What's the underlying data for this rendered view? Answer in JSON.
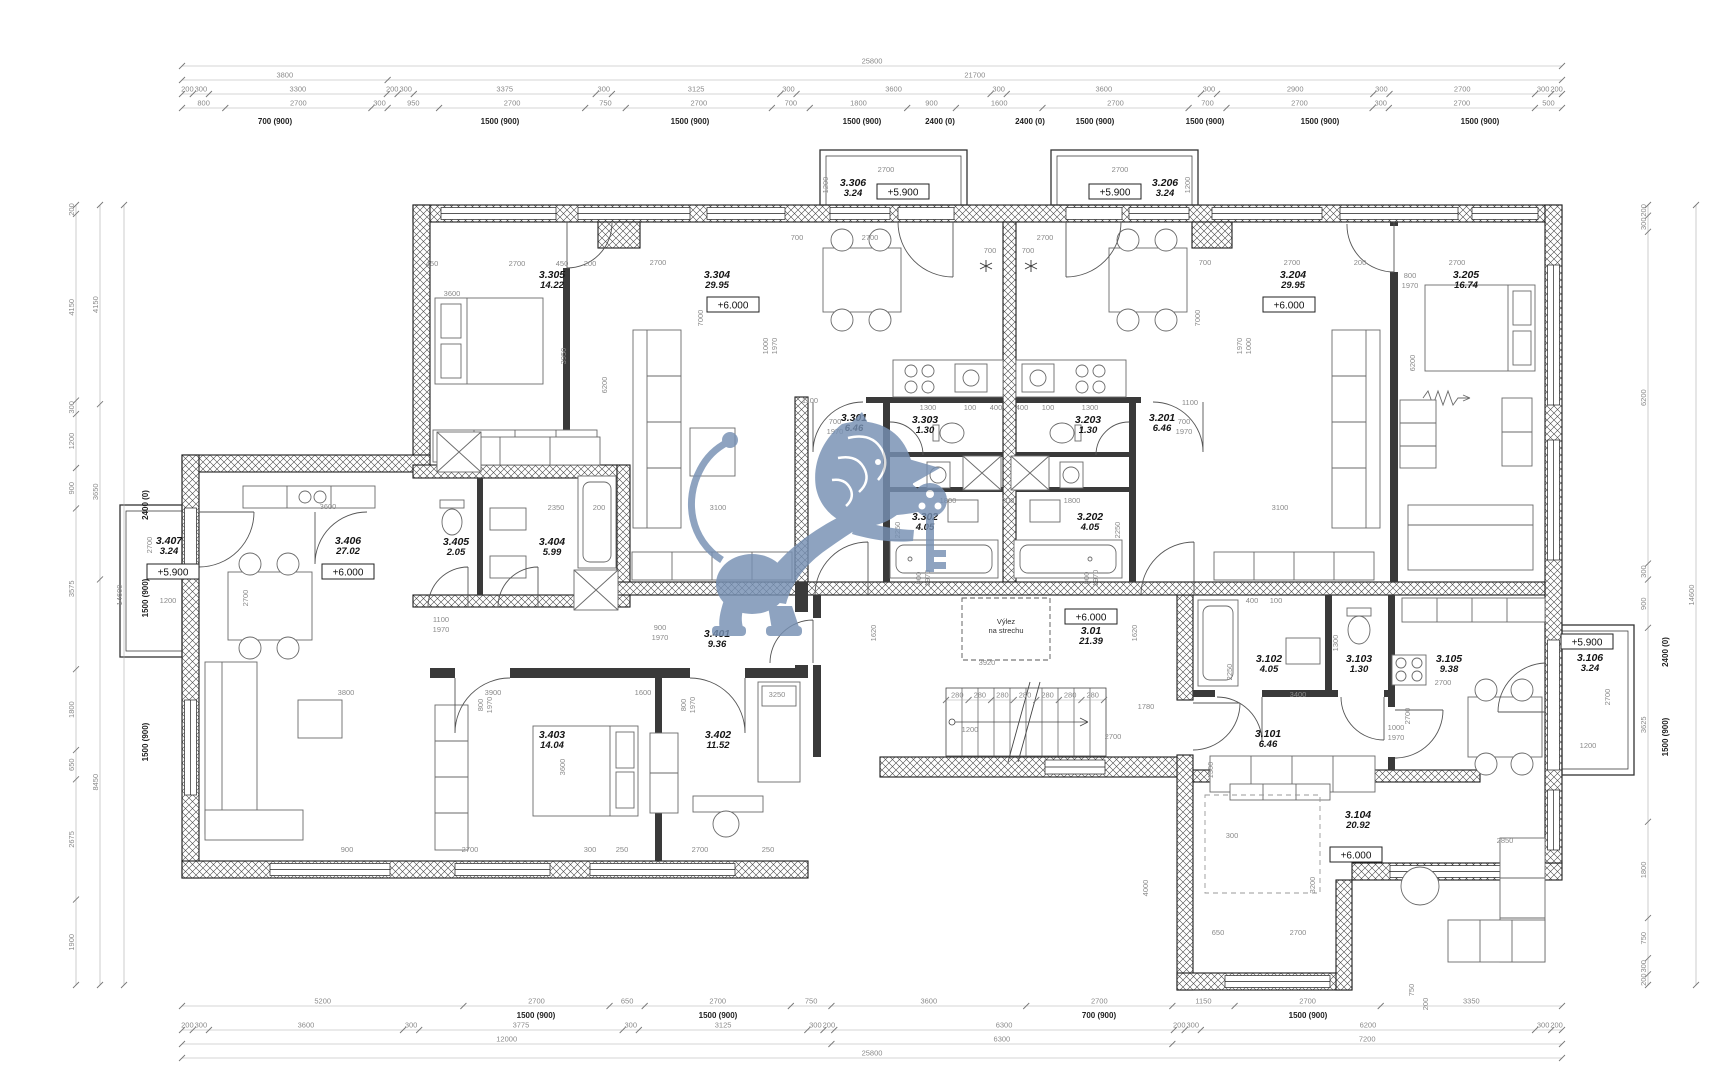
{
  "title": "Floor plan drawing — level +6.000, apartments 3.101–3.407 with common staircase 3.01",
  "watermark": {
    "icon": "lion-with-key-watermark",
    "color": "#7690b3"
  },
  "annotations": [
    {
      "x": 1006,
      "y": 624,
      "t": "Výlez"
    },
    {
      "x": 1006,
      "y": 633,
      "t": "na strechu"
    }
  ],
  "rooms": [
    {
      "id": "3.305",
      "area": "14.22",
      "x": 552,
      "y": 278
    },
    {
      "id": "3.304",
      "area": "29.95",
      "x": 717,
      "y": 278,
      "elev": "+6.000",
      "ex": 733,
      "ey": 305
    },
    {
      "id": "3.306",
      "area": "3.24",
      "x": 853,
      "y": 186,
      "elev": "+5.900",
      "ex": 903,
      "ey": 192
    },
    {
      "id": "3.301",
      "area": "6.46",
      "x": 854,
      "y": 421
    },
    {
      "id": "3.303",
      "area": "1.30",
      "x": 925,
      "y": 423
    },
    {
      "id": "3.302",
      "area": "4.05",
      "x": 925,
      "y": 520
    },
    {
      "id": "3.203",
      "area": "1.30",
      "x": 1088,
      "y": 423
    },
    {
      "id": "3.202",
      "area": "4.05",
      "x": 1090,
      "y": 520
    },
    {
      "id": "3.201",
      "area": "6.46",
      "x": 1162,
      "y": 421
    },
    {
      "id": "3.204",
      "area": "29.95",
      "x": 1293,
      "y": 278,
      "elev": "+6.000",
      "ex": 1289,
      "ey": 305
    },
    {
      "id": "3.206",
      "area": "3.24",
      "x": 1165,
      "y": 186,
      "elev": "+5.900",
      "ex": 1115,
      "ey": 192
    },
    {
      "id": "3.205",
      "area": "16.74",
      "x": 1466,
      "y": 278
    },
    {
      "id": "3.407",
      "area": "3.24",
      "x": 169,
      "y": 544,
      "elev": "+5.900",
      "ex": 173,
      "ey": 572
    },
    {
      "id": "3.406",
      "area": "27.02",
      "x": 348,
      "y": 544,
      "elev": "+6.000",
      "ex": 348,
      "ey": 572
    },
    {
      "id": "3.405",
      "area": "2.05",
      "x": 456,
      "y": 545
    },
    {
      "id": "3.404",
      "area": "5.99",
      "x": 552,
      "y": 545
    },
    {
      "id": "3.401",
      "area": "9.36",
      "x": 717,
      "y": 637
    },
    {
      "id": "3.403",
      "area": "14.04",
      "x": 552,
      "y": 738
    },
    {
      "id": "3.402",
      "area": "11.52",
      "x": 718,
      "y": 738
    },
    {
      "id": "3.01",
      "area": "21.39",
      "x": 1091,
      "y": 634,
      "elev": "+6.000",
      "ex": 1091,
      "ey": 617
    },
    {
      "id": "3.101",
      "area": "6.46",
      "x": 1268,
      "y": 737
    },
    {
      "id": "3.102",
      "area": "4.05",
      "x": 1269,
      "y": 662
    },
    {
      "id": "3.103",
      "area": "1.30",
      "x": 1359,
      "y": 662
    },
    {
      "id": "3.105",
      "area": "9.38",
      "x": 1449,
      "y": 662
    },
    {
      "id": "3.104",
      "area": "20.92",
      "x": 1358,
      "y": 818,
      "elev": "+6.000",
      "ex": 1356,
      "ey": 855
    },
    {
      "id": "3.106",
      "area": "3.24",
      "x": 1590,
      "y": 661,
      "elev": "+5.900",
      "ex": 1587,
      "ey": 642
    }
  ],
  "dims": {
    "h": [
      {
        "y": 66,
        "x0": 182,
        "x1": 1562,
        "items": [
          "25800"
        ]
      },
      {
        "y": 80,
        "x0": 182,
        "x1": 1562,
        "items": [
          "3800",
          "21700"
        ]
      },
      {
        "y": 94,
        "x0": 182,
        "x1": 1562,
        "items": [
          "200",
          "300",
          "3300",
          "200",
          "300",
          "3375",
          "300",
          "3125",
          "300",
          "3600",
          "300",
          "3600",
          "300",
          "2900",
          "300",
          "2700",
          "300",
          "200"
        ]
      },
      {
        "y": 108,
        "x0": 182,
        "x1": 1562,
        "items": [
          "800",
          "2700",
          "300",
          "950",
          "2700",
          "750",
          "2700",
          "700",
          "1800",
          "900",
          "1600",
          "2700",
          "700",
          "2700",
          "300",
          "2700",
          "500"
        ]
      },
      {
        "y": 1006,
        "x0": 182,
        "x1": 1562,
        "items": [
          "5200",
          "2700",
          "650",
          "2700",
          "750",
          "3600",
          "2700",
          "1150",
          "2700",
          "3350"
        ]
      },
      {
        "y": 1030,
        "x0": 182,
        "x1": 1562,
        "items": [
          "200",
          "300",
          "3600",
          "300",
          "3775",
          "300",
          "3125",
          "300",
          "200",
          "6300",
          "200",
          "300",
          "6200",
          "300",
          "200"
        ]
      },
      {
        "y": 1044,
        "x0": 182,
        "x1": 1562,
        "items": [
          "12000",
          "6300",
          "7200"
        ]
      },
      {
        "y": 1058,
        "x0": 182,
        "x1": 1562,
        "items": [
          "25800"
        ]
      },
      {
        "y": 700,
        "x0": 946,
        "x1": 1104,
        "items": [
          "280",
          "280",
          "280",
          "280",
          "280",
          "280",
          "280"
        ]
      }
    ],
    "v": [
      {
        "x": 76,
        "y0": 205,
        "y1": 985,
        "items": [
          "200",
          "4150",
          "300",
          "1200",
          "900",
          "3575",
          "1800",
          "650",
          "2675",
          "1900"
        ]
      },
      {
        "x": 100,
        "y0": 205,
        "y1": 985,
        "items": [
          "4150",
          "3650",
          "8450"
        ]
      },
      {
        "x": 124,
        "y0": 205,
        "y1": 985,
        "items": [
          "14600"
        ]
      },
      {
        "x": 1648,
        "y0": 205,
        "y1": 985,
        "items": [
          "200",
          "300",
          "6200",
          "300",
          "900",
          "3625",
          "1800",
          "750",
          "300",
          "200"
        ]
      },
      {
        "x": 1696,
        "y0": 205,
        "y1": 985,
        "items": [
          "14600"
        ]
      }
    ],
    "free": [
      {
        "x": 275,
        "y": 124,
        "t": "700 (900)",
        "b": 1
      },
      {
        "x": 500,
        "y": 124,
        "t": "1500 (900)",
        "b": 1
      },
      {
        "x": 690,
        "y": 124,
        "t": "1500 (900)",
        "b": 1
      },
      {
        "x": 862,
        "y": 124,
        "t": "1500 (900)",
        "b": 1
      },
      {
        "x": 940,
        "y": 124,
        "t": "2400 (0)",
        "b": 1
      },
      {
        "x": 1030,
        "y": 124,
        "t": "2400 (0)",
        "b": 1
      },
      {
        "x": 1095,
        "y": 124,
        "t": "1500 (900)",
        "b": 1
      },
      {
        "x": 1205,
        "y": 124,
        "t": "1500 (900)",
        "b": 1
      },
      {
        "x": 1320,
        "y": 124,
        "t": "1500 (900)",
        "b": 1
      },
      {
        "x": 1480,
        "y": 124,
        "t": "1500 (900)",
        "b": 1
      },
      {
        "x": 536,
        "y": 1018,
        "t": "1500 (900)",
        "b": 1
      },
      {
        "x": 718,
        "y": 1018,
        "t": "1500 (900)",
        "b": 1
      },
      {
        "x": 1099,
        "y": 1018,
        "t": "700 (900)",
        "b": 1
      },
      {
        "x": 1308,
        "y": 1018,
        "t": "1500 (900)",
        "b": 1
      },
      {
        "x": 148,
        "y": 505,
        "t": "2400 (0)",
        "b": 1,
        "r": 1
      },
      {
        "x": 148,
        "y": 598,
        "t": "1500 (900)",
        "b": 1,
        "r": 1
      },
      {
        "x": 148,
        "y": 742,
        "t": "1500 (900)",
        "b": 1,
        "r": 1
      },
      {
        "x": 1668,
        "y": 652,
        "t": "2400 (0)",
        "b": 1,
        "r": 1
      },
      {
        "x": 1668,
        "y": 737,
        "t": "1500 (900)",
        "b": 1,
        "r": 1
      },
      {
        "x": 1414,
        "y": 990,
        "t": "750",
        "r": 1
      },
      {
        "x": 1428,
        "y": 1004,
        "t": "200",
        "r": 1
      },
      {
        "x": 432,
        "y": 266,
        "t": "450"
      },
      {
        "x": 517,
        "y": 266,
        "t": "2700"
      },
      {
        "x": 562,
        "y": 266,
        "t": "450"
      },
      {
        "x": 590,
        "y": 266,
        "t": "200"
      },
      {
        "x": 658,
        "y": 265,
        "t": "2700"
      },
      {
        "x": 797,
        "y": 240,
        "t": "700"
      },
      {
        "x": 870,
        "y": 240,
        "t": "2700"
      },
      {
        "x": 990,
        "y": 253,
        "t": "700"
      },
      {
        "x": 1028,
        "y": 253,
        "t": "700"
      },
      {
        "x": 1045,
        "y": 240,
        "t": "2700"
      },
      {
        "x": 1205,
        "y": 265,
        "t": "700"
      },
      {
        "x": 1292,
        "y": 265,
        "t": "2700"
      },
      {
        "x": 1360,
        "y": 265,
        "t": "200"
      },
      {
        "x": 1410,
        "y": 278,
        "t": "800"
      },
      {
        "x": 1410,
        "y": 288,
        "t": "1970"
      },
      {
        "x": 1457,
        "y": 265,
        "t": "2700"
      },
      {
        "x": 452,
        "y": 296,
        "t": "3600"
      },
      {
        "x": 566,
        "y": 356,
        "t": "3950",
        "r": 1
      },
      {
        "x": 607,
        "y": 385,
        "t": "6200",
        "r": 1
      },
      {
        "x": 1415,
        "y": 363,
        "t": "6200",
        "r": 1
      },
      {
        "x": 703,
        "y": 318,
        "t": "7000",
        "r": 1
      },
      {
        "x": 1200,
        "y": 318,
        "t": "7000",
        "r": 1
      },
      {
        "x": 768,
        "y": 346,
        "t": "1000",
        "r": 1
      },
      {
        "x": 777,
        "y": 346,
        "t": "1970",
        "r": 1
      },
      {
        "x": 1242,
        "y": 346,
        "t": "1970",
        "r": 1
      },
      {
        "x": 1251,
        "y": 346,
        "t": "1000",
        "r": 1
      },
      {
        "x": 835,
        "y": 424,
        "t": "700"
      },
      {
        "x": 835,
        "y": 434,
        "t": "1970"
      },
      {
        "x": 1184,
        "y": 424,
        "t": "700"
      },
      {
        "x": 1184,
        "y": 434,
        "t": "1970"
      },
      {
        "x": 928,
        "y": 410,
        "t": "1300"
      },
      {
        "x": 970,
        "y": 410,
        "t": "100"
      },
      {
        "x": 996,
        "y": 410,
        "t": "400"
      },
      {
        "x": 1022,
        "y": 410,
        "t": "400"
      },
      {
        "x": 1048,
        "y": 410,
        "t": "100"
      },
      {
        "x": 1090,
        "y": 410,
        "t": "1300"
      },
      {
        "x": 948,
        "y": 503,
        "t": "1800"
      },
      {
        "x": 1008,
        "y": 503,
        "t": "200"
      },
      {
        "x": 1072,
        "y": 503,
        "t": "1800"
      },
      {
        "x": 900,
        "y": 530,
        "t": "2250",
        "r": 1
      },
      {
        "x": 1120,
        "y": 530,
        "t": "2250",
        "r": 1
      },
      {
        "x": 921,
        "y": 578,
        "t": "900",
        "r": 1
      },
      {
        "x": 930,
        "y": 578,
        "t": "1970",
        "r": 1
      },
      {
        "x": 1089,
        "y": 578,
        "t": "900",
        "r": 1
      },
      {
        "x": 1098,
        "y": 578,
        "t": "1970",
        "r": 1
      },
      {
        "x": 810,
        "y": 403,
        "t": "1100"
      },
      {
        "x": 1190,
        "y": 405,
        "t": "1100"
      },
      {
        "x": 718,
        "y": 510,
        "t": "3100"
      },
      {
        "x": 1280,
        "y": 510,
        "t": "3100"
      },
      {
        "x": 556,
        "y": 510,
        "t": "2350"
      },
      {
        "x": 599,
        "y": 510,
        "t": "200"
      },
      {
        "x": 660,
        "y": 630,
        "t": "900"
      },
      {
        "x": 660,
        "y": 640,
        "t": "1970"
      },
      {
        "x": 441,
        "y": 622,
        "t": "1100"
      },
      {
        "x": 441,
        "y": 632,
        "t": "1970"
      },
      {
        "x": 493,
        "y": 695,
        "t": "3900"
      },
      {
        "x": 643,
        "y": 695,
        "t": "1600"
      },
      {
        "x": 777,
        "y": 697,
        "t": "3250"
      },
      {
        "x": 346,
        "y": 695,
        "t": "3800"
      },
      {
        "x": 483,
        "y": 705,
        "t": "800",
        "r": 1
      },
      {
        "x": 492,
        "y": 705,
        "t": "1970",
        "r": 1
      },
      {
        "x": 686,
        "y": 705,
        "t": "800",
        "r": 1
      },
      {
        "x": 695,
        "y": 705,
        "t": "1970",
        "r": 1
      },
      {
        "x": 565,
        "y": 767,
        "t": "3600",
        "r": 1
      },
      {
        "x": 347,
        "y": 852,
        "t": "900"
      },
      {
        "x": 470,
        "y": 852,
        "t": "2700"
      },
      {
        "x": 590,
        "y": 852,
        "t": "300"
      },
      {
        "x": 622,
        "y": 852,
        "t": "250"
      },
      {
        "x": 700,
        "y": 852,
        "t": "2700"
      },
      {
        "x": 768,
        "y": 852,
        "t": "250"
      },
      {
        "x": 328,
        "y": 509,
        "t": "3600"
      },
      {
        "x": 248,
        "y": 598,
        "t": "2700",
        "r": 1
      },
      {
        "x": 168,
        "y": 603,
        "t": "1200"
      },
      {
        "x": 152,
        "y": 545,
        "t": "2700",
        "r": 1
      },
      {
        "x": 886,
        "y": 172,
        "t": "2700"
      },
      {
        "x": 828,
        "y": 185,
        "t": "1200",
        "r": 1
      },
      {
        "x": 1120,
        "y": 172,
        "t": "2700"
      },
      {
        "x": 1190,
        "y": 185,
        "t": "1200",
        "r": 1
      },
      {
        "x": 970,
        "y": 732,
        "t": "1200"
      },
      {
        "x": 1113,
        "y": 739,
        "t": "2700"
      },
      {
        "x": 1146,
        "y": 709,
        "t": "1780"
      },
      {
        "x": 987,
        "y": 665,
        "t": "3920"
      },
      {
        "x": 876,
        "y": 633,
        "t": "1620",
        "r": 1
      },
      {
        "x": 1137,
        "y": 633,
        "t": "1620",
        "r": 1
      },
      {
        "x": 1213,
        "y": 770,
        "t": "1300",
        "r": 1
      },
      {
        "x": 1232,
        "y": 672,
        "t": "2250",
        "r": 1
      },
      {
        "x": 1298,
        "y": 697,
        "t": "3400"
      },
      {
        "x": 1338,
        "y": 643,
        "t": "1300",
        "r": 1
      },
      {
        "x": 1396,
        "y": 730,
        "t": "1000"
      },
      {
        "x": 1396,
        "y": 740,
        "t": "1970"
      },
      {
        "x": 1443,
        "y": 685,
        "t": "2700"
      },
      {
        "x": 1410,
        "y": 716,
        "t": "2700",
        "r": 1
      },
      {
        "x": 1610,
        "y": 697,
        "t": "2700",
        "r": 1
      },
      {
        "x": 1588,
        "y": 748,
        "t": "1200"
      },
      {
        "x": 1218,
        "y": 935,
        "t": "650"
      },
      {
        "x": 1298,
        "y": 935,
        "t": "2700"
      },
      {
        "x": 1315,
        "y": 885,
        "t": "3200",
        "r": 1
      },
      {
        "x": 1148,
        "y": 888,
        "t": "4000",
        "r": 1
      },
      {
        "x": 1232,
        "y": 838,
        "t": "300"
      },
      {
        "x": 1505,
        "y": 843,
        "t": "2850"
      },
      {
        "x": 1252,
        "y": 603,
        "t": "400"
      },
      {
        "x": 1276,
        "y": 603,
        "t": "100"
      }
    ]
  }
}
